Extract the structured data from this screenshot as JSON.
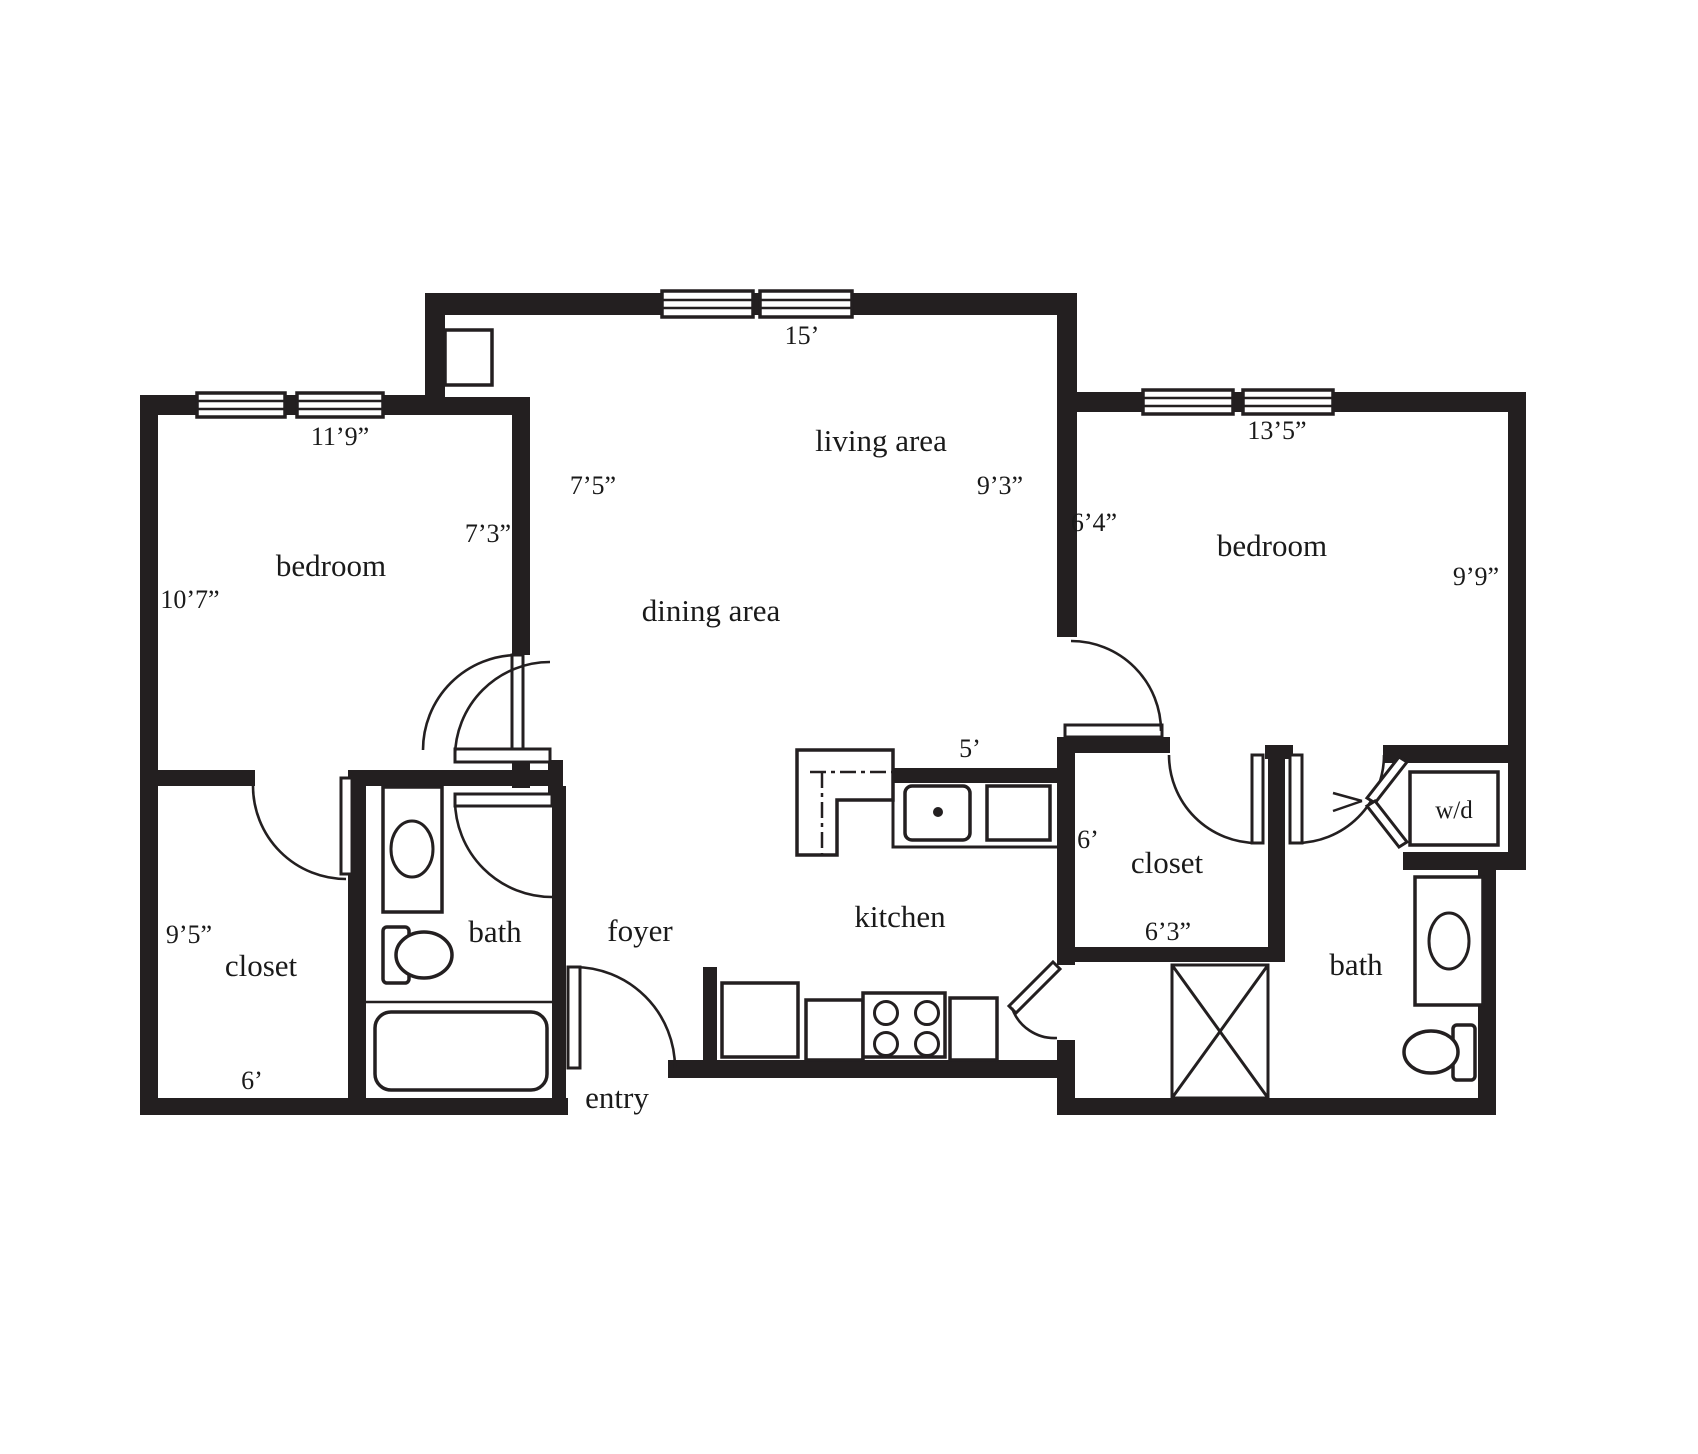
{
  "plan_type": "two-bedroom apartment floor plan",
  "colors": {
    "walls": "#231f20",
    "text": "#1a1a1a",
    "background": "#ffffff"
  },
  "rooms": {
    "bedroom_left": {
      "label": "bedroom",
      "dim_window_wall": "11’9”",
      "dim_left_wall": "10’7”",
      "dim_east_wall": "7’3”"
    },
    "dining_area": {
      "label": "dining area",
      "dim_west_wall": "7’5”"
    },
    "living_area": {
      "label": "living area",
      "dim_window_wall": "15’",
      "dim_east_wall": "9’3”"
    },
    "bedroom_right": {
      "label": "bedroom",
      "dim_window_wall": "13’5”",
      "dim_west_wall": "6’4”",
      "dim_east_wall": "9’9”"
    },
    "kitchen": {
      "label": "kitchen",
      "dim_counter": "5’"
    },
    "closet_left": {
      "label": "closet",
      "dim_left_wall": "9’5”",
      "dim_bottom_wall": "6’"
    },
    "bath_left": {
      "label": "bath"
    },
    "foyer": {
      "label": "foyer"
    },
    "entry": {
      "label": "entry"
    },
    "closet_right": {
      "label": "closet",
      "dim_west_wall": "6’",
      "dim_bottom_wall": "6’3”"
    },
    "bath_right": {
      "label": "bath"
    },
    "laundry": {
      "label": "w/d"
    }
  },
  "fixtures": [
    "kitchen-island",
    "kitchen-sink",
    "refrigerator",
    "range-4-burner",
    "counter",
    "washer-dryer",
    "bathtub",
    "vanity-sink",
    "toilet",
    "utility-x-box",
    "wall-niche"
  ]
}
